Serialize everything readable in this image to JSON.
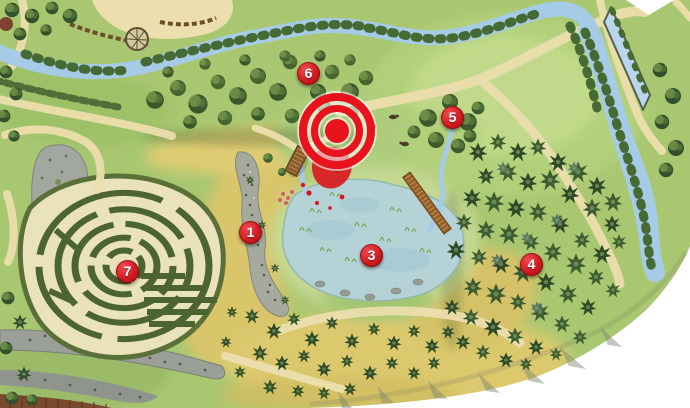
{
  "map": {
    "markers": [
      {
        "label": "1",
        "x": 250,
        "y": 232
      },
      {
        "label": "3",
        "x": 371,
        "y": 255
      },
      {
        "label": "4",
        "x": 531,
        "y": 264
      },
      {
        "label": "5",
        "x": 452,
        "y": 117
      },
      {
        "label": "6",
        "x": 308,
        "y": 73
      },
      {
        "label": "7",
        "x": 127,
        "y": 271
      }
    ],
    "target": {
      "x": 337,
      "y": 131
    },
    "obscured_marker": {
      "x": 337,
      "y": 159
    },
    "colors": {
      "marker_red": "#cf1b20",
      "marker_red_dark": "#a30c12",
      "marker_red_light": "#ef4a50",
      "target_red": "#e8131d",
      "obscured_red": "#c1131a"
    }
  }
}
